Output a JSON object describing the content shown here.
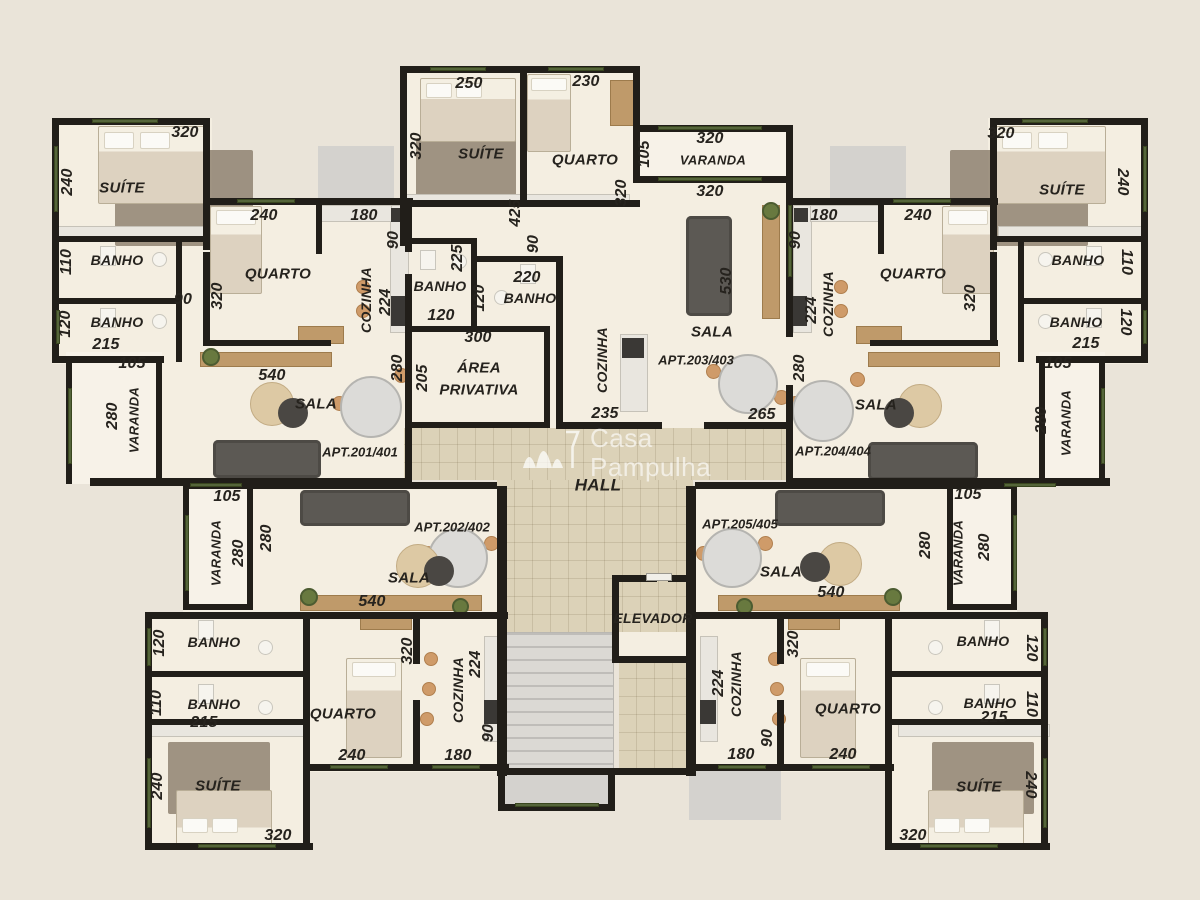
{
  "colors": {
    "background": "#eae4d9",
    "wall": "#211e19",
    "floor": "#f4eee1",
    "varanda_floor": "#f7f2e8",
    "hall_floor": "#dcd2b8",
    "window_green": "#55653a"
  },
  "watermark": {
    "line1": "Casa",
    "line2": "Pampulha"
  },
  "labels": [
    {
      "t": "320",
      "x": 185,
      "y": 133,
      "k": "dim"
    },
    {
      "t": "240",
      "x": 68,
      "y": 182,
      "r": -90,
      "k": "dim"
    },
    {
      "t": "SUÍTE",
      "x": 122,
      "y": 188,
      "k": "room"
    },
    {
      "t": "BANHO",
      "x": 117,
      "y": 260,
      "k": "room",
      "s": 14
    },
    {
      "t": "110",
      "x": 67,
      "y": 262,
      "r": -90,
      "k": "dim"
    },
    {
      "t": "BANHO",
      "x": 117,
      "y": 322,
      "k": "room",
      "s": 14
    },
    {
      "t": "120",
      "x": 66,
      "y": 324,
      "r": -90,
      "k": "dim"
    },
    {
      "t": "215",
      "x": 106,
      "y": 345,
      "k": "dim"
    },
    {
      "t": "105",
      "x": 132,
      "y": 364,
      "k": "dim"
    },
    {
      "t": "90",
      "x": 183,
      "y": 300,
      "k": "dim"
    },
    {
      "t": "VARANDA",
      "x": 134,
      "y": 420,
      "r": -90,
      "k": "room",
      "s": 13
    },
    {
      "t": "280",
      "x": 113,
      "y": 416,
      "r": -90,
      "k": "dim"
    },
    {
      "t": "240",
      "x": 264,
      "y": 216,
      "k": "dim"
    },
    {
      "t": "320",
      "x": 218,
      "y": 296,
      "r": -90,
      "k": "dim"
    },
    {
      "t": "QUARTO",
      "x": 278,
      "y": 274,
      "k": "room"
    },
    {
      "t": "180",
      "x": 364,
      "y": 216,
      "k": "dim"
    },
    {
      "t": "90",
      "x": 394,
      "y": 240,
      "r": -90,
      "k": "dim"
    },
    {
      "t": "COZINHA",
      "x": 366,
      "y": 300,
      "r": -90,
      "k": "room",
      "s": 14
    },
    {
      "t": "224",
      "x": 386,
      "y": 302,
      "r": -90,
      "k": "dim"
    },
    {
      "t": "BANHO",
      "x": 440,
      "y": 286,
      "k": "room",
      "s": 14
    },
    {
      "t": "225",
      "x": 458,
      "y": 258,
      "r": -90,
      "k": "dim"
    },
    {
      "t": "120",
      "x": 441,
      "y": 316,
      "k": "dim"
    },
    {
      "t": "540",
      "x": 272,
      "y": 376,
      "k": "dim"
    },
    {
      "t": "SALA",
      "x": 316,
      "y": 404,
      "k": "room"
    },
    {
      "t": "APT.201/401",
      "x": 360,
      "y": 452,
      "k": "apt"
    },
    {
      "t": "280",
      "x": 398,
      "y": 368,
      "r": -90,
      "k": "dim"
    },
    {
      "t": "205",
      "x": 423,
      "y": 378,
      "r": -90,
      "k": "dim"
    },
    {
      "t": "300",
      "x": 478,
      "y": 338,
      "k": "dim"
    },
    {
      "t": "ÁREA",
      "x": 479,
      "y": 368,
      "k": "room"
    },
    {
      "t": "PRIVATIVA",
      "x": 479,
      "y": 390,
      "k": "room"
    },
    {
      "t": "250",
      "x": 469,
      "y": 84,
      "k": "dim"
    },
    {
      "t": "320",
      "x": 417,
      "y": 146,
      "r": -90,
      "k": "dim"
    },
    {
      "t": "SUÍTE",
      "x": 481,
      "y": 154,
      "k": "room"
    },
    {
      "t": "230",
      "x": 586,
      "y": 82,
      "k": "dim"
    },
    {
      "t": "QUARTO",
      "x": 585,
      "y": 160,
      "k": "room"
    },
    {
      "t": "320",
      "x": 622,
      "y": 193,
      "r": -90,
      "k": "dim"
    },
    {
      "t": "425",
      "x": 516,
      "y": 213,
      "r": -90,
      "k": "dim"
    },
    {
      "t": "90",
      "x": 534,
      "y": 244,
      "r": -90,
      "k": "dim"
    },
    {
      "t": "220",
      "x": 527,
      "y": 278,
      "k": "dim"
    },
    {
      "t": "BANHO",
      "x": 530,
      "y": 298,
      "k": "room",
      "s": 14
    },
    {
      "t": "120",
      "x": 480,
      "y": 298,
      "r": -90,
      "k": "dim"
    },
    {
      "t": "105",
      "x": 645,
      "y": 154,
      "r": -90,
      "k": "dim"
    },
    {
      "t": "320",
      "x": 710,
      "y": 139,
      "k": "dim"
    },
    {
      "t": "VARANDA",
      "x": 713,
      "y": 160,
      "k": "room",
      "s": 13
    },
    {
      "t": "320",
      "x": 710,
      "y": 192,
      "k": "dim"
    },
    {
      "t": "530",
      "x": 727,
      "y": 281,
      "r": -90,
      "k": "dim"
    },
    {
      "t": "SALA",
      "x": 712,
      "y": 332,
      "k": "room"
    },
    {
      "t": "APT.203/403",
      "x": 696,
      "y": 360,
      "k": "apt"
    },
    {
      "t": "COZINHA",
      "x": 602,
      "y": 360,
      "r": -90,
      "k": "room",
      "s": 14
    },
    {
      "t": "235",
      "x": 605,
      "y": 414,
      "k": "dim"
    },
    {
      "t": "265",
      "x": 762,
      "y": 415,
      "k": "dim"
    },
    {
      "t": "180",
      "x": 824,
      "y": 216,
      "k": "dim"
    },
    {
      "t": "90",
      "x": 796,
      "y": 240,
      "r": -90,
      "k": "dim"
    },
    {
      "t": "COZINHA",
      "x": 828,
      "y": 304,
      "r": -90,
      "k": "room",
      "s": 14
    },
    {
      "t": "224",
      "x": 812,
      "y": 310,
      "r": -90,
      "k": "dim"
    },
    {
      "t": "240",
      "x": 918,
      "y": 216,
      "k": "dim"
    },
    {
      "t": "QUARTO",
      "x": 913,
      "y": 274,
      "k": "room"
    },
    {
      "t": "320",
      "x": 971,
      "y": 298,
      "r": -90,
      "k": "dim"
    },
    {
      "t": "320",
      "x": 1001,
      "y": 134,
      "k": "dim"
    },
    {
      "t": "SUÍTE",
      "x": 1062,
      "y": 190,
      "k": "room"
    },
    {
      "t": "240",
      "x": 1122,
      "y": 182,
      "r": 90,
      "k": "dim"
    },
    {
      "t": "BANHO",
      "x": 1078,
      "y": 260,
      "k": "room",
      "s": 14
    },
    {
      "t": "110",
      "x": 1126,
      "y": 262,
      "r": 90,
      "k": "dim"
    },
    {
      "t": "BANHO",
      "x": 1076,
      "y": 322,
      "k": "room",
      "s": 14
    },
    {
      "t": "120",
      "x": 1125,
      "y": 322,
      "r": 90,
      "k": "dim"
    },
    {
      "t": "215",
      "x": 1086,
      "y": 344,
      "k": "dim"
    },
    {
      "t": "105",
      "x": 1058,
      "y": 364,
      "k": "dim"
    },
    {
      "t": "280",
      "x": 800,
      "y": 368,
      "r": -90,
      "k": "dim"
    },
    {
      "t": "SALA",
      "x": 876,
      "y": 405,
      "k": "room"
    },
    {
      "t": "APT.204/404",
      "x": 833,
      "y": 451,
      "k": "apt"
    },
    {
      "t": "280",
      "x": 1042,
      "y": 420,
      "r": -90,
      "k": "dim"
    },
    {
      "t": "VARANDA",
      "x": 1066,
      "y": 423,
      "r": -90,
      "k": "room",
      "s": 13
    },
    {
      "t": "HALL",
      "x": 598,
      "y": 485,
      "k": "room",
      "s": 17
    },
    {
      "t": "105",
      "x": 227,
      "y": 497,
      "k": "dim"
    },
    {
      "t": "VARANDA",
      "x": 216,
      "y": 553,
      "r": -90,
      "k": "room",
      "s": 13
    },
    {
      "t": "280",
      "x": 239,
      "y": 553,
      "r": -90,
      "k": "dim"
    },
    {
      "t": "280",
      "x": 267,
      "y": 538,
      "r": -90,
      "k": "dim"
    },
    {
      "t": "APT.202/402",
      "x": 452,
      "y": 527,
      "k": "apt"
    },
    {
      "t": "SALA",
      "x": 409,
      "y": 578,
      "k": "room"
    },
    {
      "t": "540",
      "x": 372,
      "y": 602,
      "k": "dim"
    },
    {
      "t": "BANHO",
      "x": 214,
      "y": 642,
      "k": "room",
      "s": 14
    },
    {
      "t": "120",
      "x": 160,
      "y": 643,
      "r": -90,
      "k": "dim"
    },
    {
      "t": "BANHO",
      "x": 214,
      "y": 704,
      "k": "room",
      "s": 14
    },
    {
      "t": "110",
      "x": 157,
      "y": 703,
      "r": -90,
      "k": "dim"
    },
    {
      "t": "215",
      "x": 204,
      "y": 723,
      "k": "dim"
    },
    {
      "t": "SUÍTE",
      "x": 218,
      "y": 786,
      "k": "room"
    },
    {
      "t": "240",
      "x": 158,
      "y": 786,
      "r": -90,
      "k": "dim"
    },
    {
      "t": "320",
      "x": 278,
      "y": 836,
      "k": "dim"
    },
    {
      "t": "QUARTO",
      "x": 343,
      "y": 714,
      "k": "room"
    },
    {
      "t": "240",
      "x": 352,
      "y": 756,
      "k": "dim"
    },
    {
      "t": "320",
      "x": 408,
      "y": 651,
      "r": -90,
      "k": "dim"
    },
    {
      "t": "COZINHA",
      "x": 458,
      "y": 690,
      "r": -90,
      "k": "room",
      "s": 14
    },
    {
      "t": "224",
      "x": 476,
      "y": 664,
      "r": -90,
      "k": "dim"
    },
    {
      "t": "90",
      "x": 489,
      "y": 733,
      "r": -90,
      "k": "dim"
    },
    {
      "t": "180",
      "x": 458,
      "y": 756,
      "k": "dim"
    },
    {
      "t": "ELEVADOR",
      "x": 653,
      "y": 618,
      "k": "room",
      "s": 14
    },
    {
      "t": "APT.205/405",
      "x": 740,
      "y": 524,
      "k": "apt"
    },
    {
      "t": "SALA",
      "x": 781,
      "y": 572,
      "k": "room"
    },
    {
      "t": "540",
      "x": 831,
      "y": 593,
      "k": "dim"
    },
    {
      "t": "280",
      "x": 926,
      "y": 545,
      "r": -90,
      "k": "dim"
    },
    {
      "t": "VARANDA",
      "x": 958,
      "y": 553,
      "r": -90,
      "k": "room",
      "s": 13
    },
    {
      "t": "280",
      "x": 985,
      "y": 547,
      "r": -90,
      "k": "dim"
    },
    {
      "t": "105",
      "x": 968,
      "y": 495,
      "k": "dim"
    },
    {
      "t": "COZINHA",
      "x": 736,
      "y": 684,
      "r": -90,
      "k": "room",
      "s": 14
    },
    {
      "t": "224",
      "x": 719,
      "y": 683,
      "r": -90,
      "k": "dim"
    },
    {
      "t": "90",
      "x": 768,
      "y": 738,
      "r": -90,
      "k": "dim"
    },
    {
      "t": "180",
      "x": 741,
      "y": 755,
      "k": "dim"
    },
    {
      "t": "320",
      "x": 794,
      "y": 644,
      "r": -90,
      "k": "dim"
    },
    {
      "t": "QUARTO",
      "x": 848,
      "y": 709,
      "k": "room"
    },
    {
      "t": "240",
      "x": 843,
      "y": 755,
      "k": "dim"
    },
    {
      "t": "BANHO",
      "x": 983,
      "y": 641,
      "k": "room",
      "s": 14
    },
    {
      "t": "120",
      "x": 1031,
      "y": 648,
      "r": 90,
      "k": "dim"
    },
    {
      "t": "BANHO",
      "x": 990,
      "y": 703,
      "k": "room",
      "s": 14
    },
    {
      "t": "215",
      "x": 994,
      "y": 718,
      "k": "dim"
    },
    {
      "t": "110",
      "x": 1031,
      "y": 704,
      "r": 90,
      "k": "dim"
    },
    {
      "t": "SUÍTE",
      "x": 979,
      "y": 787,
      "k": "room"
    },
    {
      "t": "240",
      "x": 1030,
      "y": 785,
      "r": 90,
      "k": "dim"
    },
    {
      "t": "320",
      "x": 913,
      "y": 836,
      "k": "dim"
    }
  ]
}
